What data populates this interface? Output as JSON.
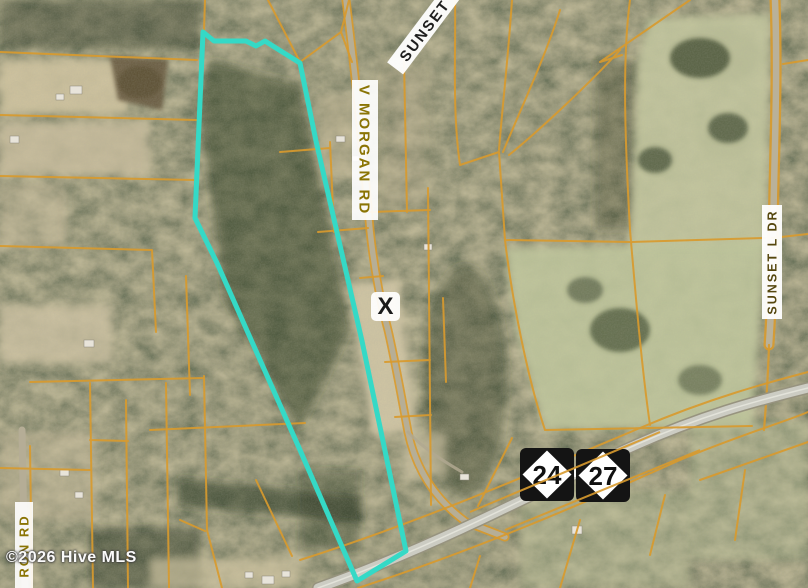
{
  "map": {
    "copyright": "©2026 Hive MLS",
    "marker": {
      "label": "X"
    },
    "road_labels": {
      "sunset_top": "SUNSET",
      "v_morgan": "V MORGAN RD",
      "sunset_l_dr": "SUNSET L DR",
      "ron_rd": "RON RD"
    },
    "route_shields": [
      {
        "number": "24"
      },
      {
        "number": "27"
      }
    ],
    "colors": {
      "boundary": "#35d9c6",
      "parcel_line": "#d89a2e",
      "label_text": "#8a7404",
      "shield_bg": "#141414",
      "shield_diamond": "#ffffff"
    }
  }
}
